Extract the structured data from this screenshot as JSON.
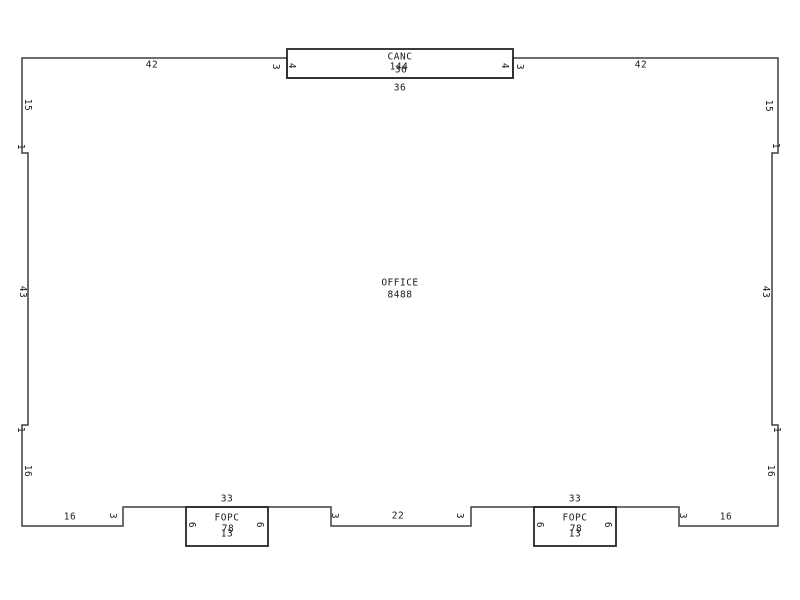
{
  "rooms": {
    "office": {
      "name": "OFFICE",
      "area": "8488"
    },
    "canc": {
      "name": "CANC",
      "area": "144",
      "width": "36"
    },
    "fopc1": {
      "name": "FOPC",
      "area": "78",
      "width": "13"
    },
    "fopc2": {
      "name": "FOPC",
      "area": "78",
      "width": "13"
    }
  },
  "dimensions": {
    "top_left_42": "42",
    "top_right_42": "42",
    "top_jog_left_3": "3",
    "top_jog_right_3": "3",
    "canc_side_left_4": "4",
    "canc_side_right_4": "4",
    "canc_below_36": "36",
    "left_upper_15": "15",
    "left_jog_upper_1": "1",
    "left_mid_43": "43",
    "left_jog_lower_1": "1",
    "left_lower_16": "16",
    "right_upper_15": "15",
    "right_jog_upper_1": "1",
    "right_mid_43": "43",
    "right_jog_lower_1": "1",
    "right_lower_16": "16",
    "bottom_left_16": "16",
    "bottom_jog_a_3": "3",
    "porch1_33": "33",
    "fopc1_left_6": "6",
    "fopc1_right_6": "6",
    "bottom_jog_b_3": "3",
    "bottom_mid_22": "22",
    "bottom_jog_c_3": "3",
    "porch2_33": "33",
    "fopc2_left_6": "6",
    "fopc2_right_6": "6",
    "bottom_jog_d_3": "3",
    "bottom_right_16": "16"
  },
  "colors": {
    "background": "#ffffff",
    "line": "#3f3f3f",
    "box_line": "#262626",
    "text": "#1a1a1a"
  }
}
